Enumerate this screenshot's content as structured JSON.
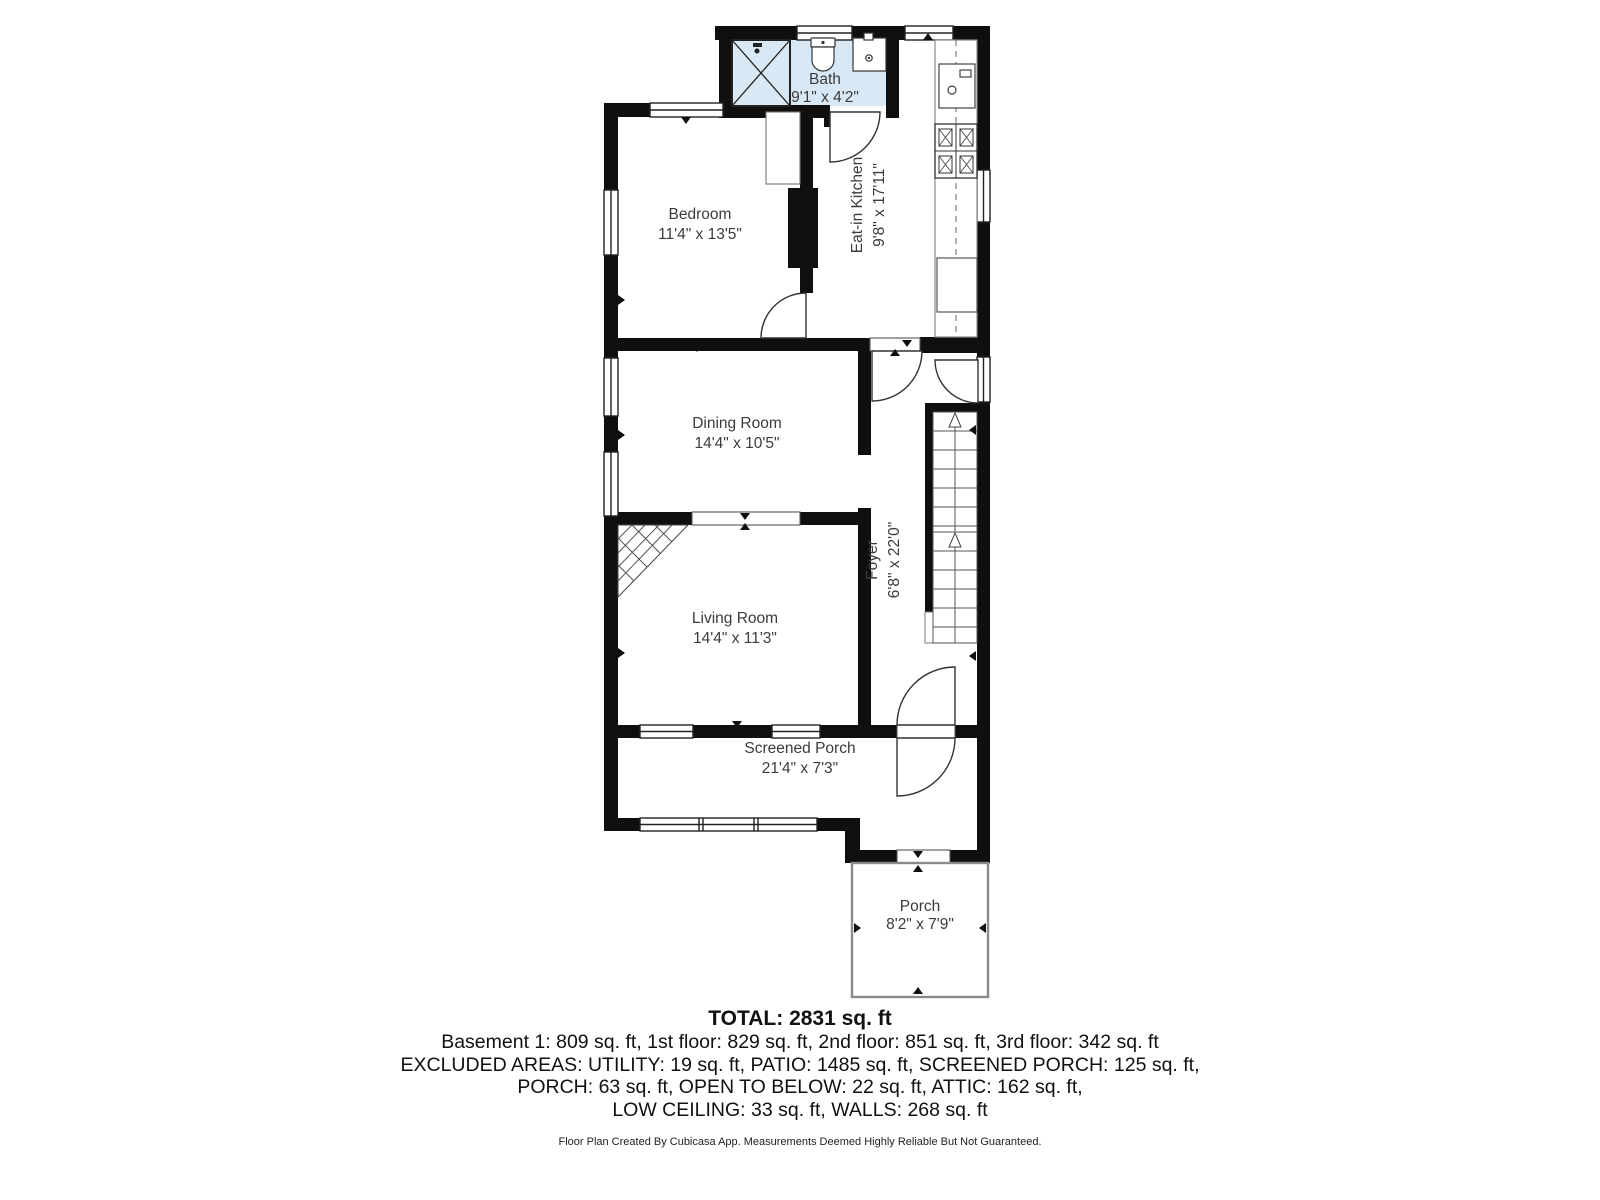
{
  "rooms": {
    "bath": {
      "name": "Bath",
      "dims": "9'1\" x 4'2\""
    },
    "bedroom": {
      "name": "Bedroom",
      "dims": "11'4\" x 13'5\""
    },
    "kitchen": {
      "name": "Eat-in Kitchen",
      "dims": "9'8\" x 17'11\""
    },
    "dining": {
      "name": "Dining Room",
      "dims": "14'4\" x 10'5\""
    },
    "foyer": {
      "name": "Foyer",
      "dims": "6'8\" x 22'0\""
    },
    "living": {
      "name": "Living Room",
      "dims": "14'4\" x 11'3\""
    },
    "screened_porch": {
      "name": "Screened Porch",
      "dims": "21'4\" x 7'3\""
    },
    "porch": {
      "name": "Porch",
      "dims": "8'2\" x 7'9\""
    }
  },
  "summary": {
    "total": "TOTAL: 2831 sq. ft",
    "line1": "Basement 1: 809 sq. ft, 1st floor: 829 sq. ft, 2nd floor: 851 sq. ft, 3rd floor: 342 sq. ft",
    "line2": "EXCLUDED AREAS: UTILITY: 19 sq. ft, PATIO: 1485 sq. ft, SCREENED PORCH: 125 sq. ft,",
    "line3": "PORCH: 63 sq. ft, OPEN TO BELOW: 22 sq. ft, ATTIC: 162 sq. ft,",
    "line4": "LOW CEILING: 33 sq. ft, WALLS: 268 sq. ft"
  },
  "footer": "Floor Plan Created By Cubicasa App. Measurements Deemed Highly Reliable But Not Guaranteed.",
  "colors": {
    "wall": "#0f0f0f",
    "bath_fill": "#d8e9f5",
    "line": "#444444"
  }
}
